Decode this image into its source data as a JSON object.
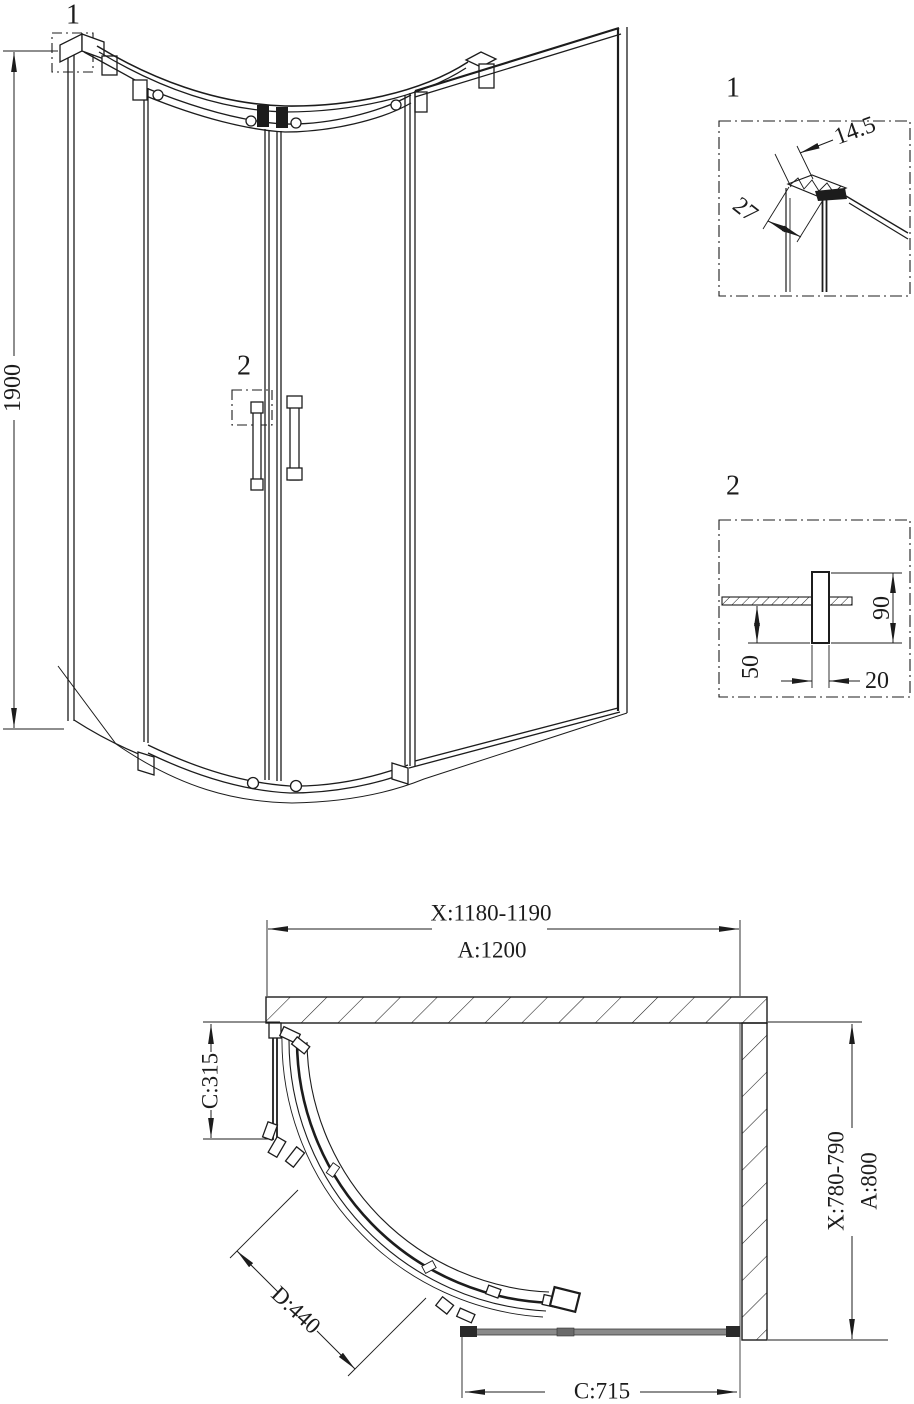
{
  "elevation": {
    "callout_1": "1",
    "callout_2": "2",
    "height": "1900"
  },
  "detail_1": {
    "label": "1",
    "top_width": "14.5",
    "profile_depth": "27"
  },
  "detail_2": {
    "label": "2",
    "handle_height": "90",
    "handle_drop": "50",
    "handle_width": "20"
  },
  "plan": {
    "width_min_max": "X:1180-1190",
    "width_overall": "A:1200",
    "side_fixed_return": "C:315",
    "door_opening": "D:440",
    "front_fixed_panel": "C:715",
    "depth_min_max": "X:780-790",
    "depth_overall": "A:800"
  },
  "colors": {
    "line": "#1c1c1c",
    "glass_gray": "#8a8a8a",
    "background": "#ffffff"
  }
}
